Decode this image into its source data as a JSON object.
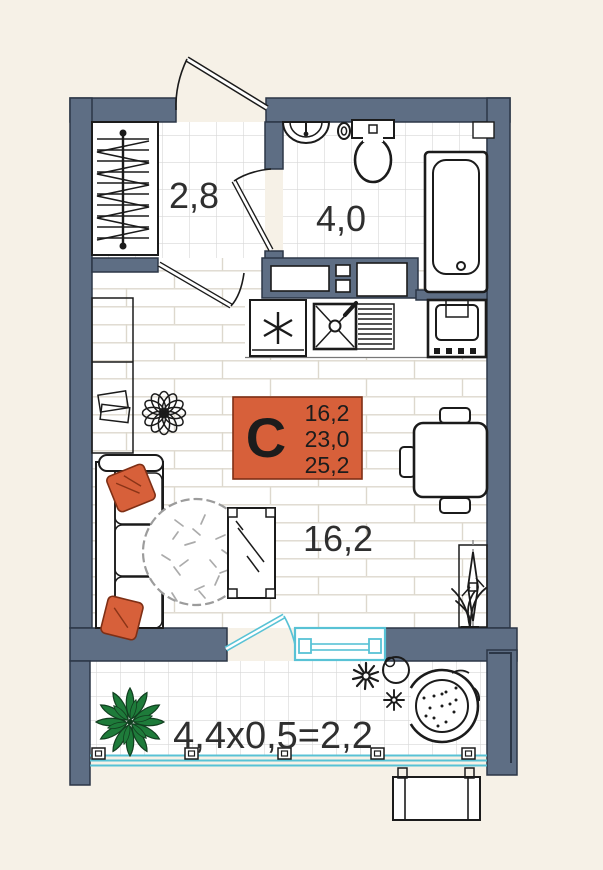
{
  "title": "Studio apartment floor plan",
  "badge": {
    "letter": "С",
    "values": [
      "16,2",
      "23,0",
      "25,2"
    ]
  },
  "labels": {
    "hallway": "2,8",
    "bathroom": "4,0",
    "living_room": "16,2",
    "balcony": "4,4х0,5=2,2"
  },
  "colors": {
    "background": "#f6f1e7",
    "wall": "#5e6e84",
    "wall_outline": "#2b3646",
    "line": "#1b1b1b",
    "accent": "#d7603a",
    "window": "#58c2d5",
    "plant": "#1e7b3a",
    "plant_outline": "#123f20",
    "text": "#2f2f2f",
    "floor_line": "#ddd8cd",
    "tile_line": "#d7d7d7",
    "soft_line": "#9c9c9c"
  },
  "icons": [
    "entrance-door",
    "wardrobe-rail",
    "interior-door",
    "bathroom-sink",
    "toilet",
    "bathtub",
    "ventilation-shaft",
    "refrigerator",
    "kitchen-sink",
    "stove",
    "dining-table",
    "stool",
    "desk",
    "books",
    "flower-decor",
    "area-badge",
    "sofa",
    "pillow",
    "rug",
    "coffee-table",
    "tv-panel",
    "floor-plant",
    "balcony-door",
    "balcony-window",
    "balcony-glazing",
    "palm-plant",
    "daisy-flowers",
    "papasan-chair",
    "ac-unit"
  ]
}
